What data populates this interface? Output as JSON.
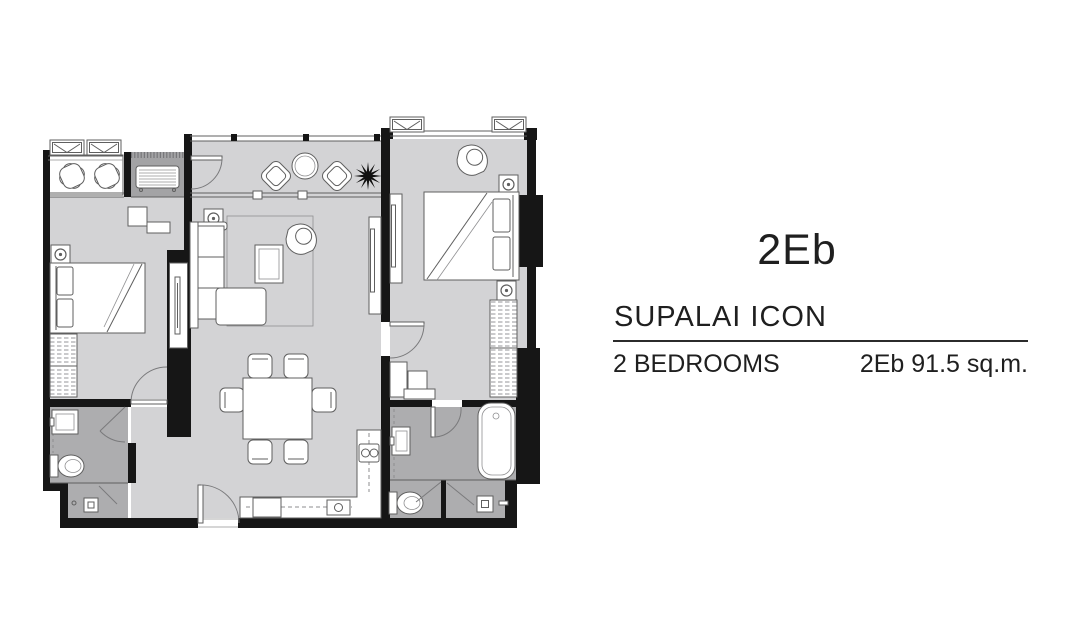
{
  "unit": {
    "code": "2Eb"
  },
  "project": {
    "name": "SUPALAI ICON"
  },
  "spec": {
    "bedrooms": "2 BEDROOMS",
    "area": "2Eb 91.5 sq.m."
  },
  "palette": {
    "floor": "#d3d3d5",
    "wet_room": "#adadaf",
    "alcove": "#a3a3a5",
    "wall": "#161616",
    "furniture_line": "#5f5f5f",
    "muted_line": "#909092",
    "text": "#1f1f1f"
  }
}
